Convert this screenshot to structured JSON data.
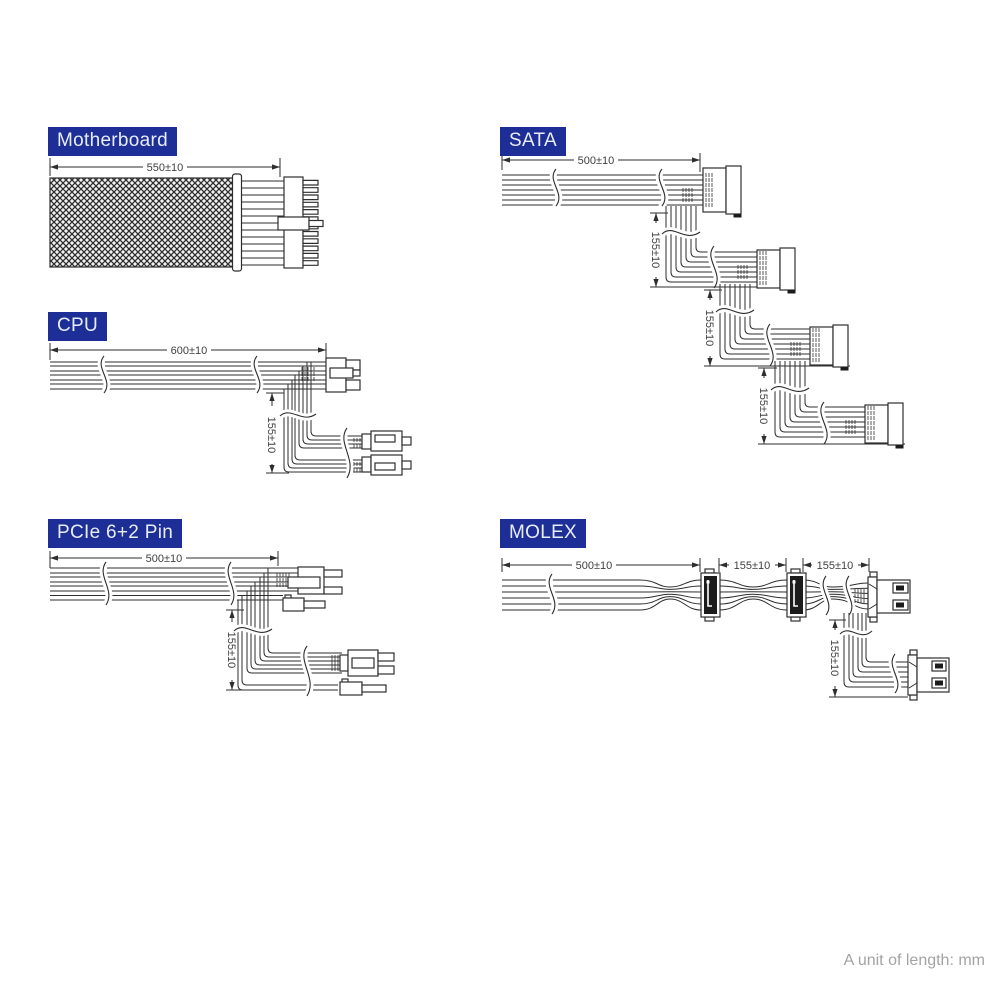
{
  "footer": {
    "note": "A unit of length: mm"
  },
  "colors": {
    "label_bg": "#1d2e96",
    "label_text": "#e8edfa",
    "line": "#2e2e2e",
    "dim_text": "#3f3f3f",
    "footer_text": "#a3a3a3",
    "connector_dark": "#1c1c1c"
  },
  "sections": {
    "motherboard": {
      "label": "Motherboard",
      "dim_length": "550±10"
    },
    "cpu": {
      "label": "CPU",
      "dim_length": "600±10",
      "dim_branch": "155±10"
    },
    "pcie": {
      "label": "PCIe 6+2 Pin",
      "dim_length": "500±10",
      "dim_branch": "155±10"
    },
    "sata": {
      "label": "SATA",
      "dim_length": "500±10",
      "dim_seg1": "155±10",
      "dim_seg2": "155±10",
      "dim_seg3": "155±10"
    },
    "molex": {
      "label": "MOLEX",
      "dim_length": "500±10",
      "dim_seg1": "155±10",
      "dim_seg2": "155±10",
      "dim_branch": "155±10"
    }
  }
}
